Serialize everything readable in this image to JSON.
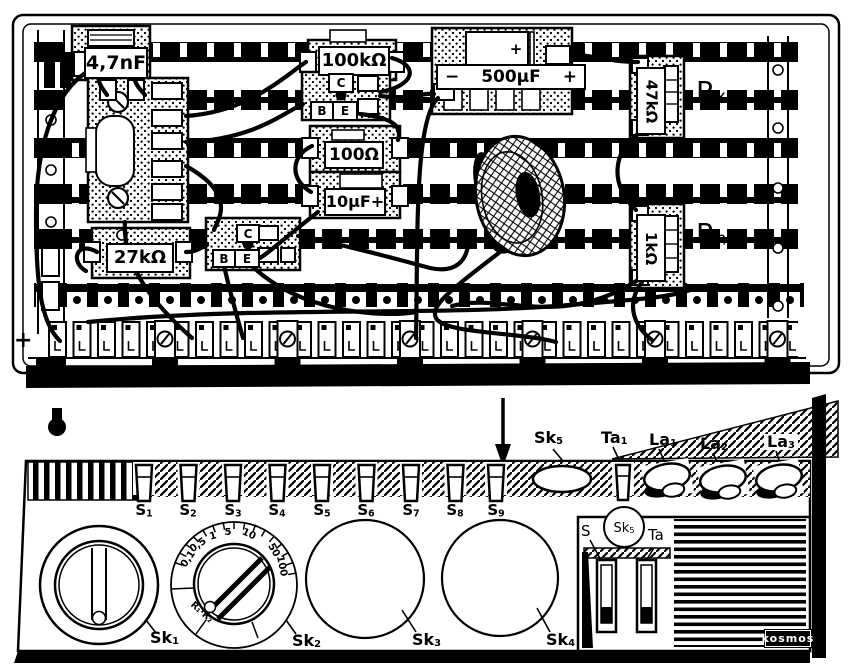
{
  "modules": {
    "cap47nf": {
      "label": "4,7nF"
    },
    "res100k": {
      "label": "100kΩ"
    },
    "res100": {
      "label": "100Ω"
    },
    "cap10uf": {
      "label": "10µF+"
    },
    "res27k": {
      "label": "27kΩ"
    },
    "cap500uf": {
      "label": "500µF",
      "minus": "−",
      "plus": "+",
      "body_plus": "+"
    },
    "res47k": {
      "label": "47kΩ"
    },
    "res1k": {
      "label": "1kΩ"
    },
    "transistor1": {
      "c": "C",
      "b": "B",
      "e": "E"
    },
    "transistor2": {
      "c": "C",
      "b": "B",
      "e": "E"
    },
    "rx": {
      "base": "R",
      "sub": "x"
    },
    "rn": {
      "base": "R",
      "sub": "n"
    }
  },
  "terminals": {
    "plus": "+"
  },
  "callouts": {
    "sk5": {
      "base": "Sk",
      "sub": "5"
    },
    "ta1": {
      "base": "Ta",
      "sub": "1"
    },
    "la1": {
      "base": "La",
      "sub": "1"
    },
    "la2": {
      "base": "La",
      "sub": "2"
    },
    "la3": {
      "base": "La",
      "sub": "3"
    }
  },
  "front": {
    "switches": [
      {
        "base": "S",
        "sub": "1"
      },
      {
        "base": "S",
        "sub": "2"
      },
      {
        "base": "S",
        "sub": "3"
      },
      {
        "base": "S",
        "sub": "4"
      },
      {
        "base": "S",
        "sub": "5"
      },
      {
        "base": "S",
        "sub": "6"
      },
      {
        "base": "S",
        "sub": "7"
      },
      {
        "base": "S",
        "sub": "8"
      },
      {
        "base": "S",
        "sub": "9"
      }
    ],
    "knobs": [
      {
        "base": "Sk",
        "sub": "1"
      },
      {
        "base": "Sk",
        "sub": "2"
      },
      {
        "base": "Sk",
        "sub": "3"
      },
      {
        "base": "Sk",
        "sub": "4"
      }
    ],
    "dial": {
      "values": [
        "0,1",
        "0,5",
        "1",
        "5",
        "10",
        "50",
        "100"
      ],
      "caption": "R₁·R₂"
    },
    "inset": {
      "s": "S",
      "sk5": {
        "base": "Sk",
        "sub": "5"
      },
      "ta": "Ta"
    },
    "brand": "kosmos"
  }
}
